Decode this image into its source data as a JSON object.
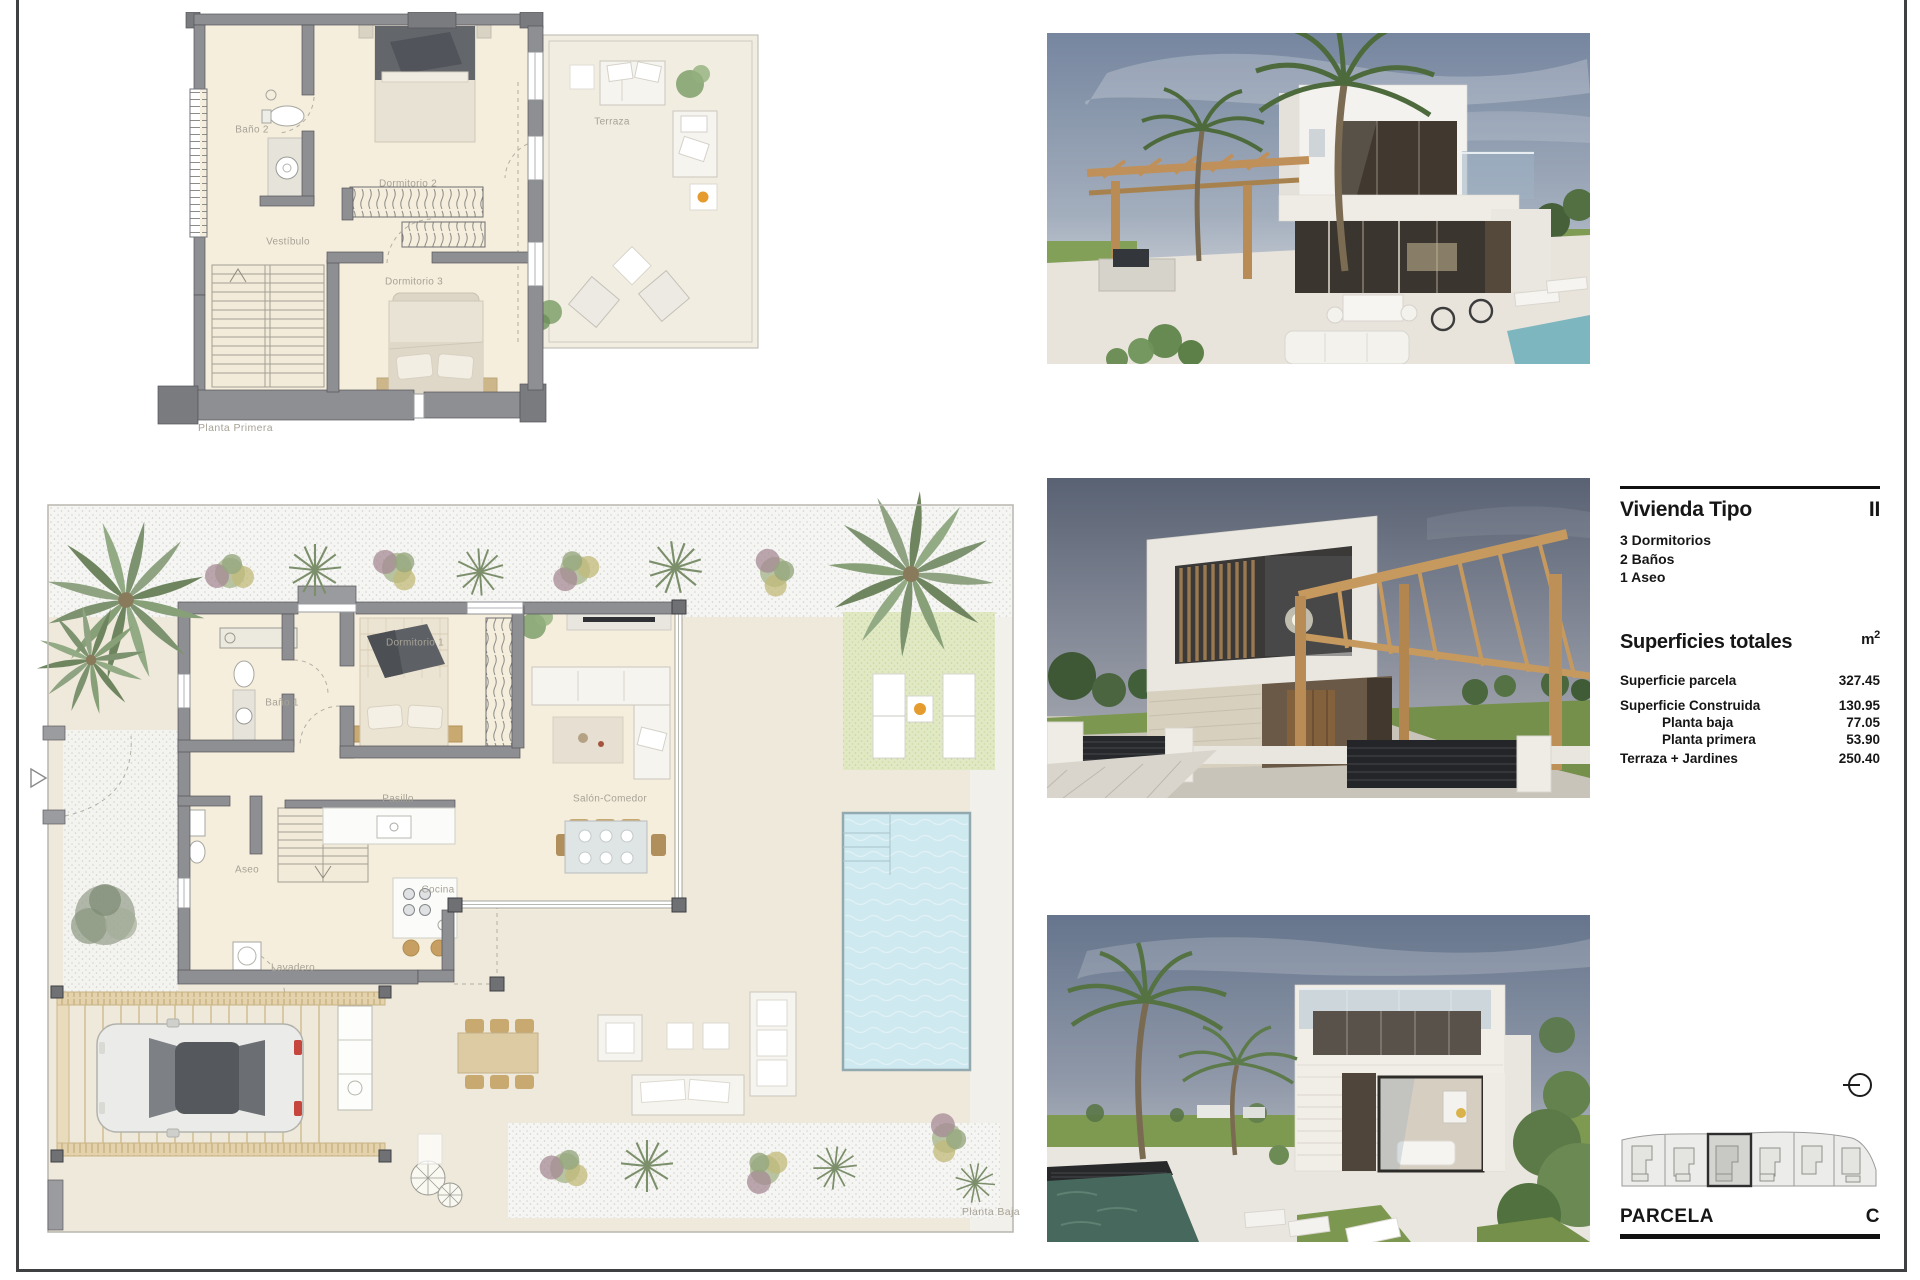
{
  "plans": {
    "planta_primera": {
      "caption": "Planta Primera",
      "rooms": {
        "bano2": "Baño 2",
        "vestibulo": "Vestíbulo",
        "dormitorio2": "Dormitorio 2",
        "dormitorio3": "Dormitorio 3",
        "terraza": "Terraza"
      }
    },
    "planta_baja": {
      "caption": "Planta Baja",
      "rooms": {
        "bano1": "Baño 1",
        "dormitorio1": "Dormitorio 1",
        "pasillo": "Pasillo",
        "aseo": "Aseo",
        "cocina": "Cocina",
        "lavadero": "Lavadero",
        "salon": "Salón-Comedor"
      }
    }
  },
  "spec": {
    "title": "Vivienda Tipo",
    "type": "II",
    "features": [
      "3 Dormitorios",
      "2 Baños",
      "1 Aseo"
    ],
    "totals_heading": "Superficies totales",
    "unit_base": "m",
    "unit_exp": "2",
    "rows": [
      {
        "label": "Superficie parcela",
        "value": "327.45"
      },
      {
        "label": "Superficie Construida",
        "value": "130.95"
      },
      {
        "label": "Planta baja",
        "value": "77.05"
      },
      {
        "label": "Planta primera",
        "value": "53.90"
      },
      {
        "label": "Terraza + Jardines",
        "value": "250.40"
      }
    ]
  },
  "parcela": {
    "label": "PARCELA",
    "value": "C"
  },
  "colors": {
    "wall_gray": "#8e8f92",
    "floor_beige": "#f5eedd",
    "pool_blue": "#cfe9f0",
    "lawn_green": "#e0e8c4",
    "wood_tan": "#c6995f",
    "ink": "#1b1b1b"
  }
}
